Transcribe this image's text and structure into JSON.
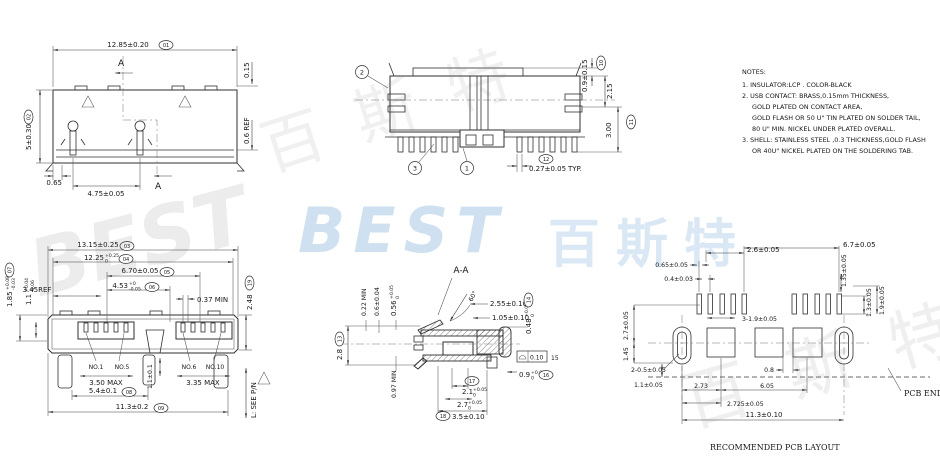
{
  "watermarks": {
    "best_blue": "BEST",
    "cn_blue": "百斯特",
    "best_gray": "BEST",
    "cn_gray_top": "百 斯 特",
    "cn_gray_bottom": "百 斯 特"
  },
  "notes": {
    "title": "NOTES:",
    "lines": [
      "1. INSULATOR:LCP . COLOR-BLACK",
      "2. USB CONTACT: BRASS,0.15mm THICKNESS,",
      "GOLD PLATED ON CONTACT AREA,",
      "GOLD FLASH OR 50 U\" TIN PLATED ON SOLDER TAIL,",
      "80 U\" MIN. NICKEL UNDER PLATED OVERALL.",
      "3. SHELL: STAINLESS STEEL ,0.3 THICKNESS,GOLD FLASH",
      "OR 40U\" NICKEL PLATED ON THE SOLDERING TAB."
    ]
  },
  "top_view": {
    "width": "12.85±0.20",
    "width_ref": "01",
    "thickness": "0.15",
    "height": "5±0.30",
    "height_ref": "02",
    "edge_ref": "0.6 REF",
    "offset": "0.65",
    "pitch": "4.75±0.05",
    "section_a": "A"
  },
  "side_view": {
    "b1": "1",
    "b2": "2",
    "b3": "3",
    "tab": "0.9±0.15",
    "tab_ref": "10",
    "mid": "2.15",
    "height": "3.00",
    "height_ref": "11",
    "tail": "0.27±0.05",
    "tail_typ": "TYP.",
    "tail_ref": "12"
  },
  "front_view": {
    "w1": "13.15±0.25",
    "w1_ref": "03",
    "w2": "12.25",
    "w2_p": "+0.25",
    "w2_m": "0",
    "w2_ref": "04",
    "w3": "6.70±0.05",
    "w3_ref": "05",
    "w4": "4.53",
    "w4_p": "+0",
    "w4_m": "-0.05",
    "w4_ref": "06",
    "ref345": "3.45REF",
    "min037": "0.37 MIN",
    "h1": "1.85",
    "h1_p": "+0.08",
    "h1_m": "-0.03",
    "h1_ref": "07",
    "h2": "1.1",
    "h2_p": "+0.04",
    "h2_m": "-0.06",
    "h3": "2.48",
    "h3_ref": "19",
    "no1": "NO.1",
    "no5": "NO.5",
    "no6": "NO.6",
    "no10": "NO.10",
    "max350": "3.50 MAX",
    "max335": "3.35 MAX",
    "slot": "1.1±0.1",
    "legs": "5.4±0.1",
    "legs_ref": "08",
    "total": "11.3±0.2",
    "total_ref": "09",
    "length_note": "L: SEE P/N"
  },
  "section_view": {
    "title": "A-A",
    "min022": "0.22 MIN",
    "d06": "0.6±0.04",
    "d056": "0.56",
    "d056_p": "+0.05",
    "d056_m": "0",
    "d28": "2.8",
    "d28_ref": "13",
    "min097": "0.97 MIN",
    "angle": "60°",
    "d255": "2.55±0.10",
    "d105": "1.05±0.10",
    "d048": "0.48",
    "d048_p": "+0.05",
    "d048_m": "0",
    "d048_ref": "14",
    "fcf": "0.10",
    "fcf_ref": "15",
    "d09": "0.9",
    "d09_p": "+0.05",
    "d09_m": "0",
    "d09_ref": "16",
    "d21_ref": "17",
    "d21": "2.1",
    "d21_p": "+0.05",
    "d21_m": "0",
    "d27": "2.7",
    "d27_p": "+0.05",
    "d27_m": "0",
    "d35": "3.5±0.10",
    "d35_ref": "18"
  },
  "pcb_view": {
    "d67": "6.7±0.05",
    "d26": "2.6±0.05",
    "d065": "0.65±0.05",
    "d04": "0.4±0.03",
    "d135": "1.35±0.05",
    "d13": "1.3±0.05",
    "d19": "1.9±0.05",
    "d319": "3-1.9±0.05",
    "d27": "2.7±0.05",
    "d145": "1.45",
    "d205": "2-0.5±0.05",
    "d11": "1.1±0.05",
    "d273": "2.73",
    "d08": "0.8",
    "d605": "6.05",
    "d2725": "2.725±0.05",
    "d113": "11.3±0.10",
    "pcb_end": "PCB END",
    "caption": "RECOMMENDED PCB LAYOUT"
  }
}
